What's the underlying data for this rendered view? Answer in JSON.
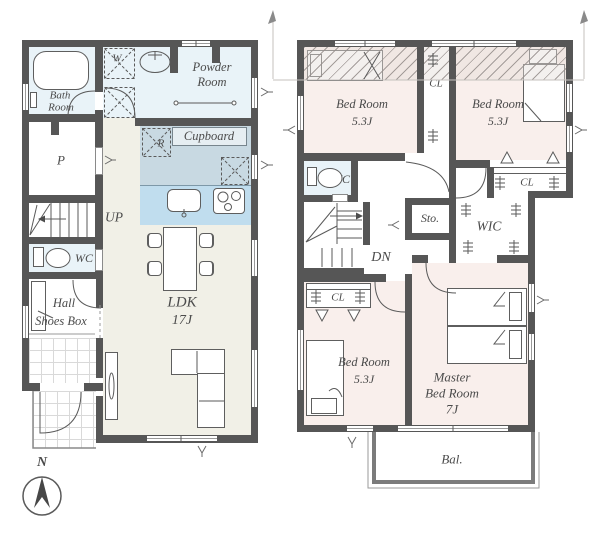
{
  "colors": {
    "wall": "#565656",
    "water_rooms": "#e9f3f8",
    "kitchen_zone": "#c8d9e2",
    "kitchen_counter": "#c0ddee",
    "bedroom_pink": "#f9efec",
    "ldk_beige": "#f1f0e7"
  },
  "floor1": {
    "bath": {
      "line1": "Bath",
      "line2": "Room"
    },
    "washer": {
      "label": "W"
    },
    "powder": {
      "line1": "Powder",
      "line2": "Room"
    },
    "pantry": {
      "label": "P"
    },
    "stairs": {
      "label": "UP"
    },
    "wc": {
      "label": "WC"
    },
    "hall": {
      "line1": "Hall",
      "line2": "Shoes Box"
    },
    "fridge": {
      "label": "R"
    },
    "cupboard": {
      "label": "Cupboard"
    },
    "ldk": {
      "line1": "LDK",
      "line2": "17J"
    }
  },
  "floor2": {
    "bedroom_nw": {
      "line1": "Bed Room",
      "line2": "5.3J"
    },
    "closet_mid": {
      "label": "CL"
    },
    "bedroom_ne": {
      "line1": "Bed Room",
      "line2": "5.3J"
    },
    "closet_ne": {
      "label": "CL"
    },
    "wc": {
      "label": "WC"
    },
    "stairs": {
      "label": "DN"
    },
    "storage": {
      "label": "Sto."
    },
    "wic": {
      "label": "WIC"
    },
    "closet_sw": {
      "label": "CL"
    },
    "bedroom_sw": {
      "line1": "Bed Room",
      "line2": "5.3J"
    },
    "master": {
      "line1": "Master",
      "line2": "Bed Room",
      "line3": "7J"
    },
    "balcony": {
      "label": "Bal."
    }
  },
  "compass": {
    "label": "N"
  }
}
